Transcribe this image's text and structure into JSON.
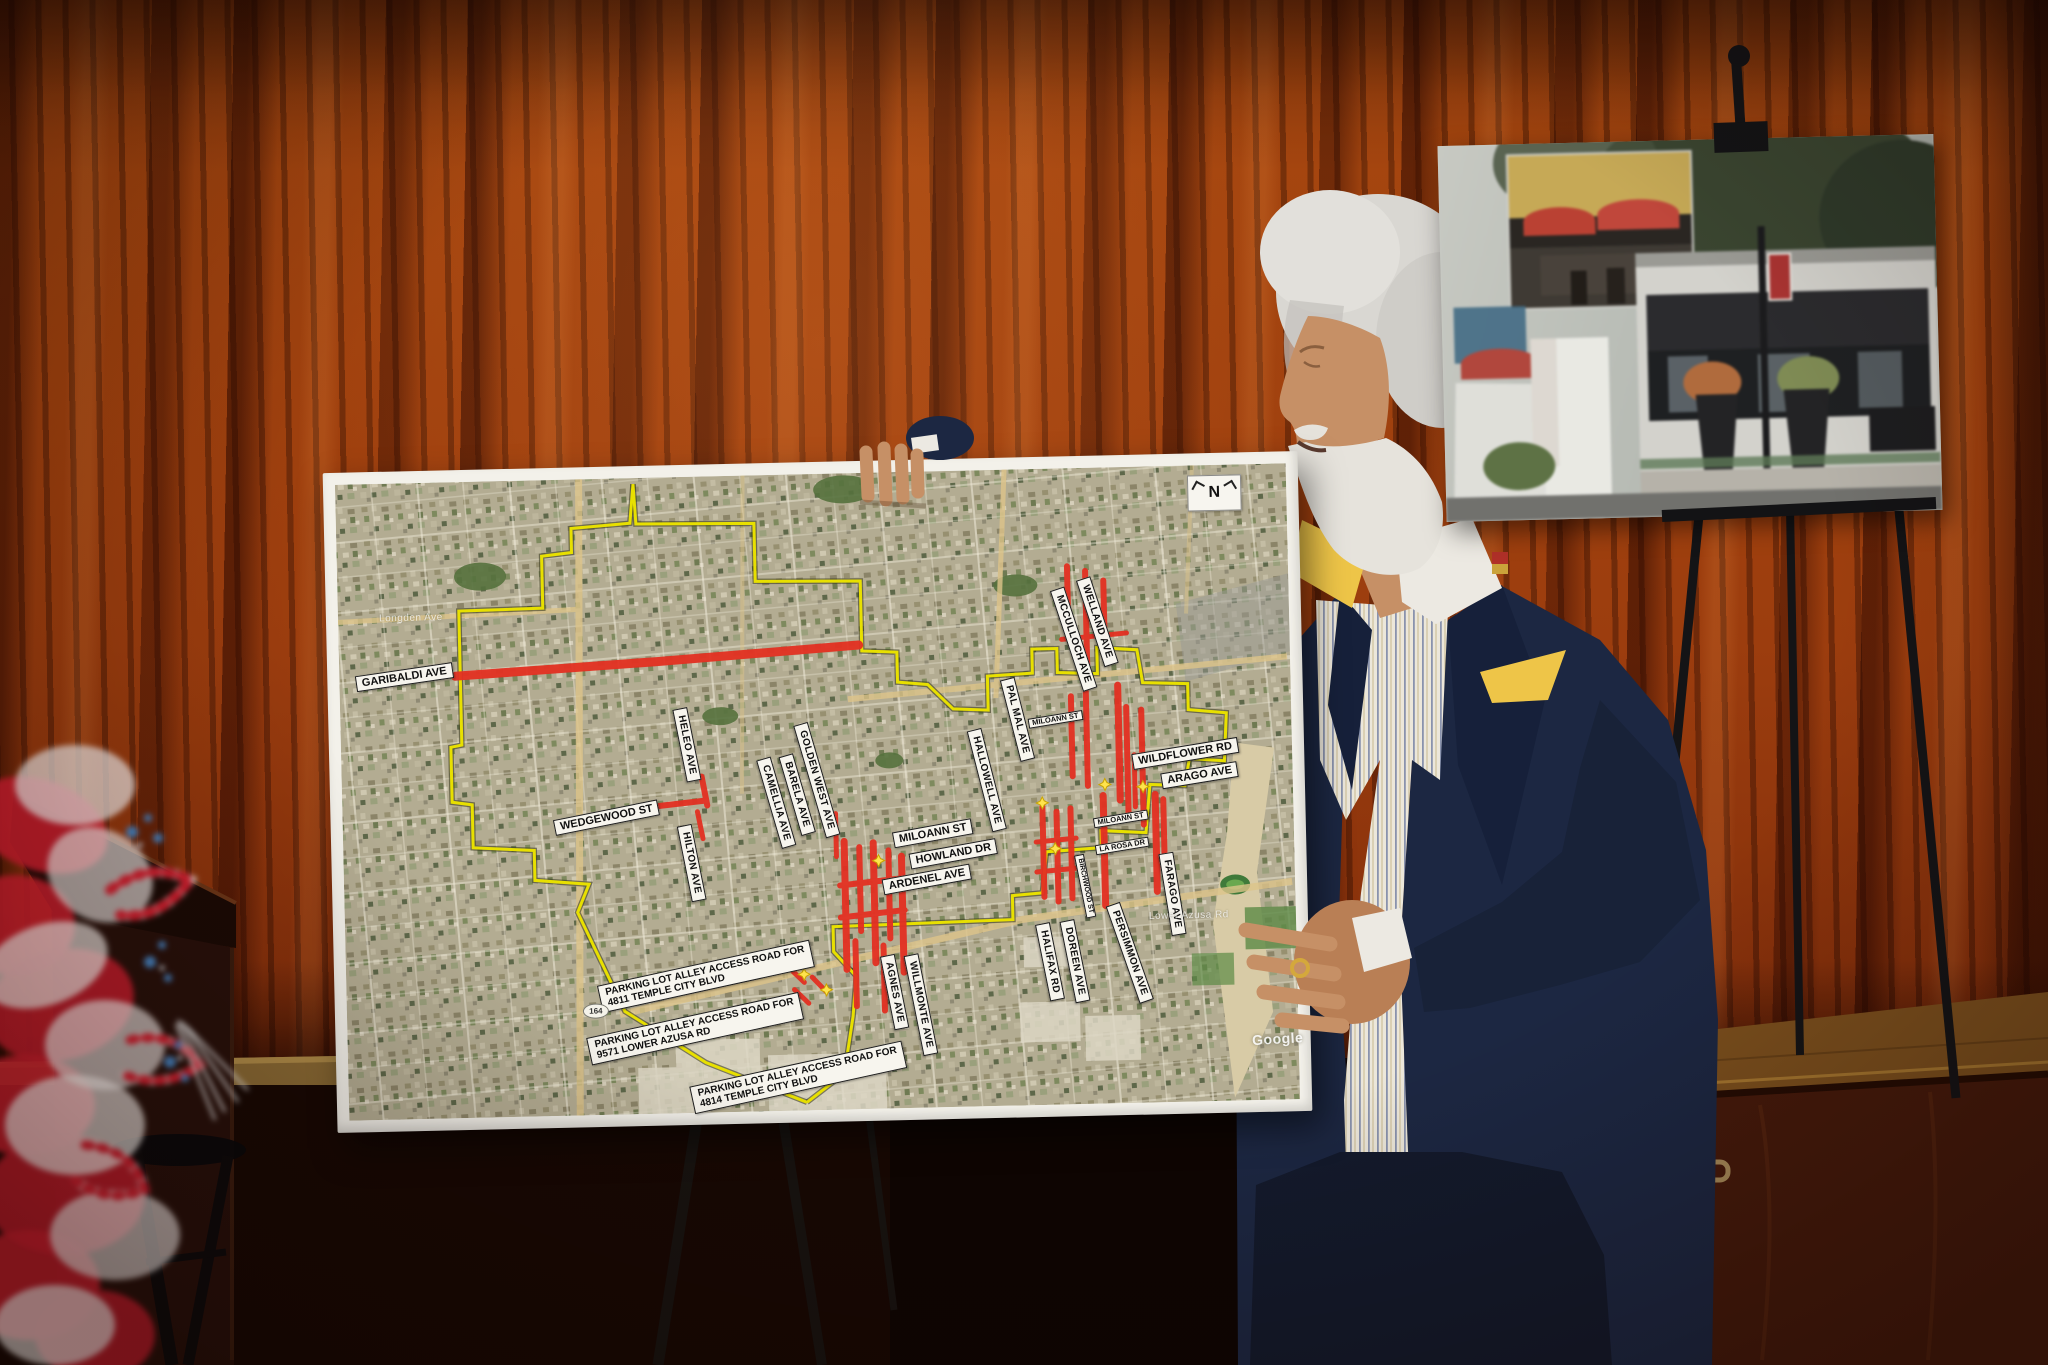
{
  "scene": {
    "setting": "presenter on a stage with red curtain showing a street-map poster and a photo collage poster on easels",
    "colors": {
      "curtain": "#a0430f",
      "suit_navy": "#1c2742",
      "pocket_square": "#eec548",
      "highlight_red": "#e33022",
      "boundary_yellow": "#e8e000",
      "map_base": "#b3ac92"
    }
  },
  "map_poster": {
    "compass_label": "N",
    "watermark": "Google",
    "route_shield": "164",
    "street_labels": [
      {
        "text": "GARIBALDI AVE",
        "x": 77,
        "y": 206,
        "rot": -7,
        "type": "h"
      },
      {
        "text": "WEDGEWOOD ST",
        "x": 276,
        "y": 351,
        "rot": -10,
        "type": "h"
      },
      {
        "text": "HELEO AVE",
        "x": 358,
        "y": 280,
        "rot": 80,
        "type": "v"
      },
      {
        "text": "HILTON AVE",
        "x": 360,
        "y": 398,
        "rot": 80,
        "type": "v"
      },
      {
        "text": "CAMELLIA AVE",
        "x": 446,
        "y": 340,
        "rot": 75,
        "type": "v"
      },
      {
        "text": "BARELA AVE",
        "x": 467,
        "y": 332,
        "rot": 75,
        "type": "v"
      },
      {
        "text": "GOLDEN WEST AVE",
        "x": 487,
        "y": 318,
        "rot": 75,
        "type": "v"
      },
      {
        "text": "MILOANN ST",
        "x": 602,
        "y": 374,
        "rot": -9,
        "type": "h"
      },
      {
        "text": "HOWLAND DR",
        "x": 622,
        "y": 395,
        "rot": -9,
        "type": "h"
      },
      {
        "text": "ARDENEL AVE",
        "x": 595,
        "y": 420,
        "rot": -9,
        "type": "h"
      },
      {
        "text": "HALLOWELL AVE",
        "x": 657,
        "y": 322,
        "rot": 77,
        "type": "v"
      },
      {
        "text": "PAL MAL AVE",
        "x": 689,
        "y": 262,
        "rot": 77,
        "type": "v"
      },
      {
        "text": "MCCULLOCH AVE",
        "x": 747,
        "y": 183,
        "rot": 73,
        "type": "v"
      },
      {
        "text": "WELLAND AVE",
        "x": 771,
        "y": 166,
        "rot": 73,
        "type": "v"
      },
      {
        "text": "MILOANN ST",
        "x": 727,
        "y": 263,
        "rot": -8,
        "type": "sh"
      },
      {
        "text": "WILDFLOWER RD",
        "x": 856,
        "y": 300,
        "rot": -8,
        "type": "h"
      },
      {
        "text": "ARAGO AVE",
        "x": 870,
        "y": 322,
        "rot": -8,
        "type": "h"
      },
      {
        "text": "MILOANN ST",
        "x": 790,
        "y": 364,
        "rot": -8,
        "type": "sh"
      },
      {
        "text": "LA ROSA DR",
        "x": 791,
        "y": 391,
        "rot": -8,
        "type": "sh"
      },
      {
        "text": "BIRCHWOOD ST",
        "x": 753,
        "y": 430,
        "rot": 80,
        "type": "sv"
      },
      {
        "text": "FARAGO AVE",
        "x": 840,
        "y": 440,
        "rot": 82,
        "type": "v"
      },
      {
        "text": "PERSIMMON AVE",
        "x": 796,
        "y": 498,
        "rot": 72,
        "type": "v"
      },
      {
        "text": "DOREEN AVE",
        "x": 741,
        "y": 505,
        "rot": 80,
        "type": "v"
      },
      {
        "text": "HALIFAX RD",
        "x": 716,
        "y": 505,
        "rot": 80,
        "type": "v"
      },
      {
        "text": "WILLMONTE AVE",
        "x": 586,
        "y": 545,
        "rot": 80,
        "type": "v"
      },
      {
        "text": "AGNES AVE",
        "x": 560,
        "y": 532,
        "rot": 80,
        "type": "v"
      },
      {
        "text": "PARKING LOT ALLEY ACCESS ROAD FOR\n4811 TEMPLE CITY BLVD",
        "x": 372,
        "y": 512,
        "rot": -11,
        "type": "p"
      },
      {
        "text": "PARKING LOT ALLEY ACCESS ROAD FOR\n9571 LOWER AZUSA RD",
        "x": 360,
        "y": 564,
        "rot": -11,
        "type": "p"
      },
      {
        "text": "PARKING LOT ALLEY ACCESS ROAD FOR\n4814 TEMPLE CITY BLVD",
        "x": 462,
        "y": 615,
        "rot": -11,
        "type": "p"
      }
    ],
    "basemap_labels": [
      {
        "text": "Longden Ave",
        "x": 85,
        "y": 147
      },
      {
        "text": "Lower Azusa Rd",
        "x": 856,
        "y": 462
      }
    ]
  }
}
